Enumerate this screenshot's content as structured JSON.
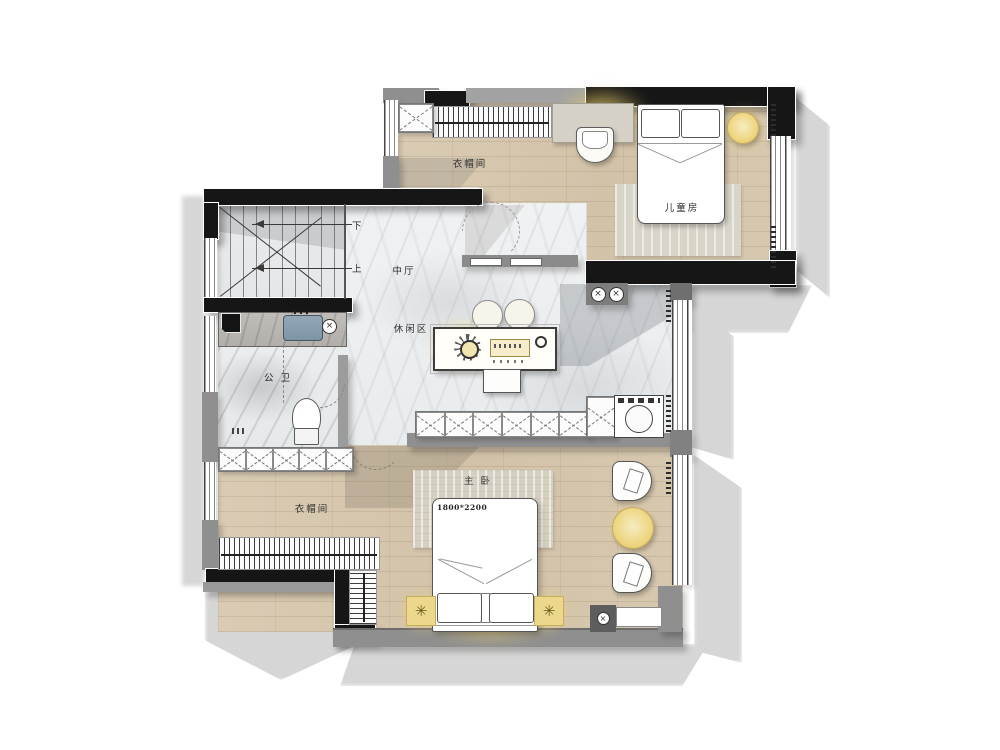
{
  "plan": {
    "rooms": {
      "kids_closet": {
        "label": "衣帽间"
      },
      "kids_room": {
        "label": "儿童房"
      },
      "hall": {
        "label": "中厅"
      },
      "leisure_area": {
        "label": "休闲区"
      },
      "bathroom": {
        "label": "公 卫"
      },
      "master_bedroom": {
        "label": "主 卧"
      },
      "master_closet": {
        "label": "衣帽间"
      }
    },
    "stairs": {
      "down_label": "下",
      "up_label": "上"
    },
    "annotations": {
      "master_bed_size": "1800*2200"
    },
    "colors": {
      "wall_dark": "#161616",
      "wall_gray": "#8f8f8f",
      "wood_floor": "#d6c6ae",
      "marble_floor": "#edeff0",
      "lamp_glow": "#f3d66e",
      "drop_shadow": "#d6d6d6"
    }
  }
}
